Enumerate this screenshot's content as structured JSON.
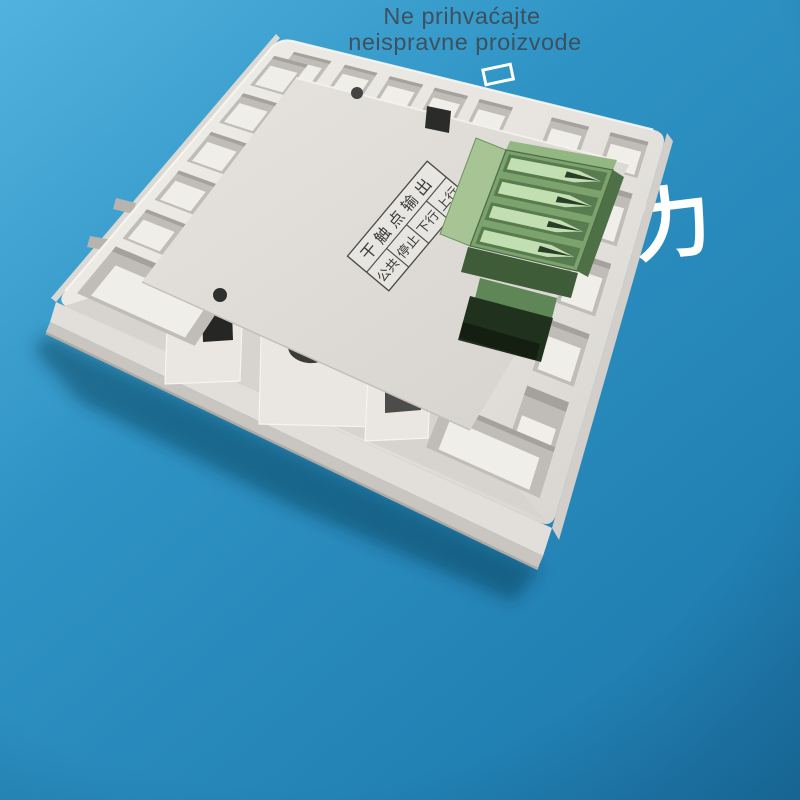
{
  "overlay_text": {
    "line1": "Ne prihvaćajte",
    "line2": "neispravne proizvode",
    "color": "#3e4d5a"
  },
  "watermark": {
    "character": "力",
    "color": "#ffffff"
  },
  "device": {
    "description": "white wall-switch back panel with green 4-slot terminal block",
    "terminal_label": {
      "header": "干触点输出",
      "cells": [
        "公共",
        "停止",
        "下行",
        "上行"
      ]
    }
  },
  "palette": {
    "bg_light": "#52b2de",
    "bg_mid": "#2e93c4",
    "bg_deep": "#1e7aad",
    "face": "#ebe8e3",
    "face_dark": "#d9d6d1",
    "plate": "#e4e1dc",
    "plate_dark": "#d4d1cc",
    "pocket_wall": "#c0bdb8",
    "pocket_floor": "#f0eee9",
    "crease": "#a5a19c",
    "wall_top": "#e2dfda",
    "wall_bottom": "#c9c6c1",
    "wall_lip": "#aeaba7",
    "band": "#d7d4cf",
    "pad": "#eae7e2",
    "pad_edge": "#f6f4f0",
    "hole_dark": "#262624",
    "hole_mid": "#4c4c4a",
    "green_face": "#7ca26d",
    "green_left": "#a6c494",
    "green_rim": "#93b783",
    "green_right": "#4e7047",
    "funnel_frame": "#587c4f",
    "funnel_mouth": "#c2dfb2",
    "funnel_slot": "#2a3d27",
    "plug_shadow": "#3f5c39",
    "plug_body": "#5e8656",
    "plug_dark": "#20311d",
    "plug_darkest": "#141f12",
    "label_line": "#4a4a48",
    "label_text": "#3a3a38",
    "shadow": "rgba(8,42,70,0.42)"
  }
}
